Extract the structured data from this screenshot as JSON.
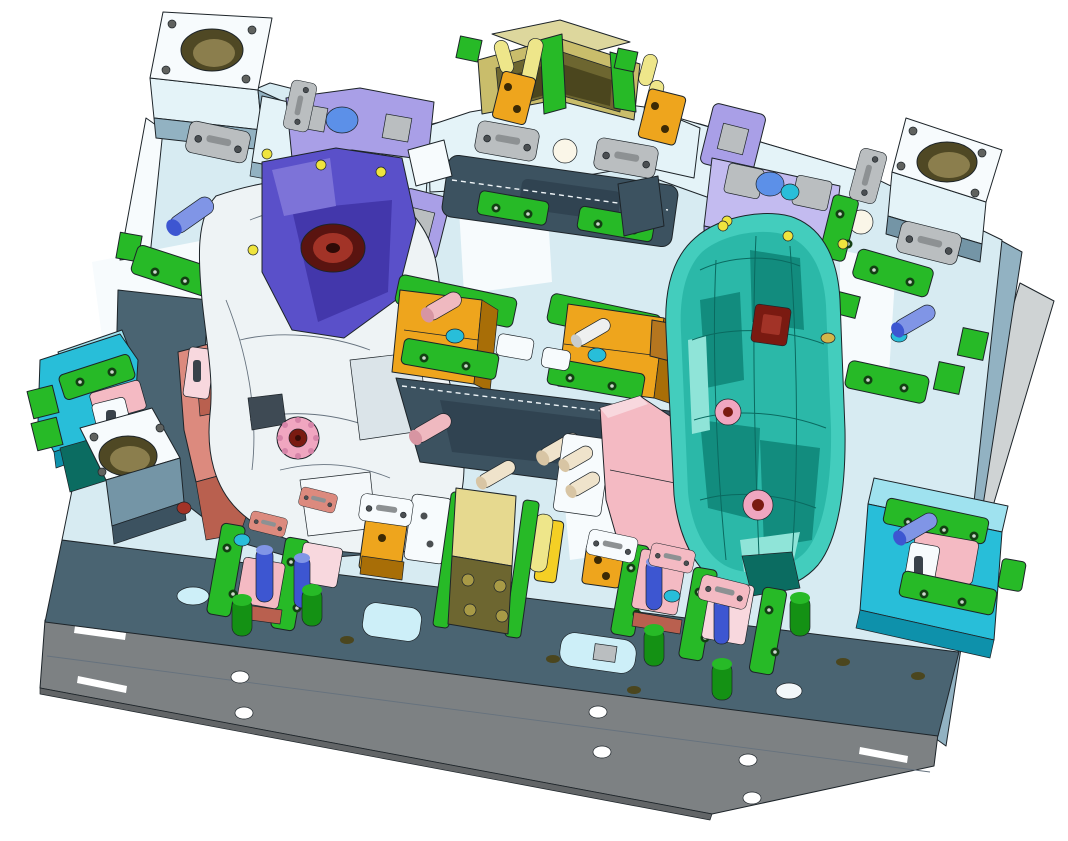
{
  "meta": {
    "description": "Isometric 3D CAD rendering of a plastic injection mold tool (parting face view) on a white background. No user-interface chrome visible; all engraved nameplate text is too small to be legible.",
    "view": "isometric",
    "background": "#ffffff"
  },
  "colors": {
    "bg": "#ffffff",
    "face": "#d7ebf2",
    "face_light": "#e4f3f8",
    "white": "#f7fbfd",
    "sky": "#cdeff8",
    "steel": "#92b2c2",
    "steel_dark": "#7495a6",
    "slate": "#4a6472",
    "slate_dark": "#3c5260",
    "slate_deep": "#304351",
    "base": "#7d8183",
    "base_dark": "#626567",
    "rail": "#cfd3d4",
    "rail_light": "#e8ebec",
    "green": "#27ba27",
    "green_dark": "#149114",
    "green_deep": "#0c5f0c",
    "green_screw": "#133f13",
    "olive_face": "#c9bd6b",
    "olive_side": "#6d6630",
    "olive_deep": "#4b461e",
    "bore_ring": "#4f4824",
    "bore": "#8b7e4d",
    "brass": "#a89a46",
    "amber": "#eea51d",
    "amber_dark": "#a86e07",
    "amber_deep": "#7a4f04",
    "yellow": "#f4cf25",
    "yellow_pale": "#eee68a",
    "yellow_dot": "#efe43e",
    "pink": "#f4bac3",
    "pink_pale": "#f8d8de",
    "pink_dark": "#d795a2",
    "salmon": "#dc8a7e",
    "salmon_dark": "#b9604f",
    "red_dark": "#7a1a11",
    "red_mid": "#a23327",
    "gear_pink": "#f0a6c0",
    "purple": "#5a50c9",
    "purple_dark": "#4337ab",
    "purple_mid": "#7d73d8",
    "lavender": "#a99fe7",
    "lavender_light": "#c3bbf0",
    "blue_blob": "#5c90e8",
    "teal_body": "#43cdbd",
    "teal_mid": "#2bb8a8",
    "teal_dark": "#128c7e",
    "teal_deep": "#0b6c61",
    "teal_light": "#dff9f4",
    "cyan": "#28bed9",
    "cyan_dark": "#0e91ab",
    "blue": "#3d56d1",
    "blue_light": "#8095e6",
    "plate": "#babec0",
    "plate_dark": "#86898b",
    "plate_screw": "#4b4f52",
    "cream": "#efe3cb",
    "gold": "#d3b64a",
    "edge": "#1d2429"
  },
  "parts": [
    {
      "id": "cavity-half",
      "label": "fixed half / A-plate",
      "color": "face"
    },
    {
      "id": "core-half",
      "label": "moving half / B-plate front",
      "color": "slate"
    },
    {
      "id": "base-plate",
      "label": "clamping base plate",
      "color": "base"
    },
    {
      "id": "guide-bushings",
      "label": "corner guide bushings",
      "color": "bore"
    },
    {
      "id": "clamp-blocks",
      "label": "clamp / wear blocks",
      "color": "green"
    },
    {
      "id": "slide-blocks",
      "label": "angled slide blocks",
      "color": "amber"
    },
    {
      "id": "lifter",
      "label": "lifter bracket assemblies",
      "color": "purple"
    },
    {
      "id": "molded-part",
      "label": "transparent molded part (door module)",
      "color": "teal_body"
    },
    {
      "id": "inserts",
      "label": "insert retainers",
      "color": "pink"
    },
    {
      "id": "slide-units",
      "label": "side slide units",
      "color": "cyan"
    },
    {
      "id": "locating-block",
      "label": "top locating / latch block",
      "color": "olive_face"
    },
    {
      "id": "dowel-pins",
      "label": "dowel pins",
      "color": "blue"
    },
    {
      "id": "name-plates",
      "label": "engraved nameplates (text illegible)",
      "color": "plate"
    }
  ]
}
